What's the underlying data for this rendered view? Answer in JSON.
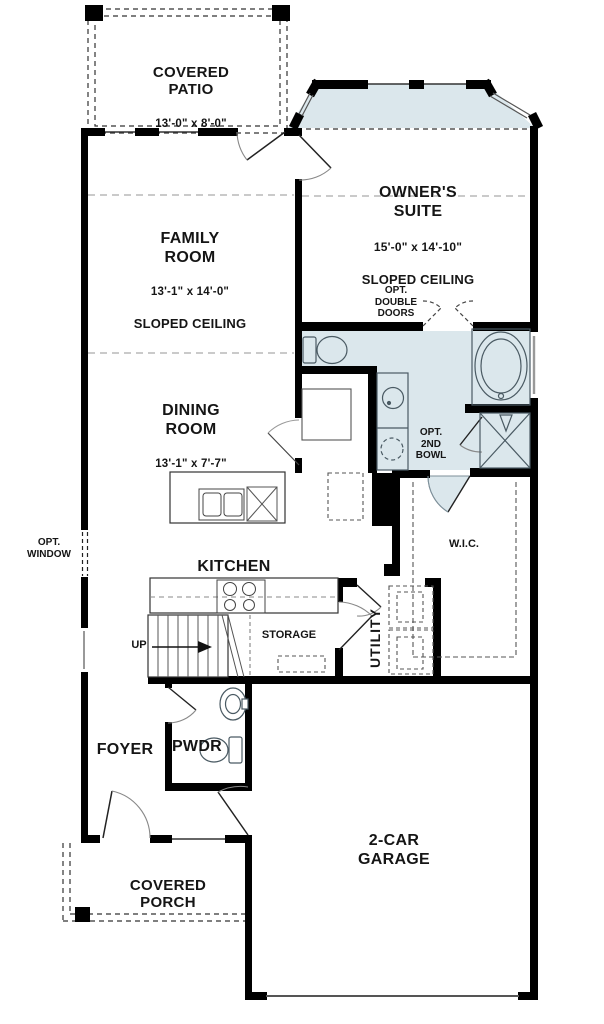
{
  "plan": {
    "colors": {
      "wall": "#000000",
      "shade": "#dbe7ec",
      "dash_gray": "#9e9e9e",
      "text": "#151515"
    },
    "rooms": {
      "covered_patio": {
        "name": "COVERED\nPATIO",
        "dims": "13'-0\" x 8'-0\""
      },
      "family_room": {
        "name": "FAMILY\nROOM",
        "dims": "13'-1\" x 14'-0\"",
        "note": "SLOPED CEILING"
      },
      "owners_suite": {
        "name": "OWNER'S\nSUITE",
        "dims": "15'-0\" x 14'-10\"",
        "note": "SLOPED CEILING"
      },
      "dining_room": {
        "name": "DINING\nROOM",
        "dims": "13'-1\" x 7'-7\""
      },
      "kitchen": {
        "name": "KITCHEN"
      },
      "wic": {
        "name": "W.I.C."
      },
      "utility": {
        "name": "UTILITY"
      },
      "storage": {
        "name": "STORAGE"
      },
      "foyer": {
        "name": "FOYER"
      },
      "powder": {
        "name": "PWDR"
      },
      "covered_porch": {
        "name": "COVERED\nPORCH"
      },
      "garage": {
        "name": "2-CAR\nGARAGE"
      }
    },
    "annotations": {
      "opt_double_doors": "OPT.\nDOUBLE\nDOORS",
      "opt_2nd_bowl": "OPT.\n2ND\nBOWL",
      "opt_window": "OPT.\nWINDOW",
      "up": "UP"
    }
  }
}
